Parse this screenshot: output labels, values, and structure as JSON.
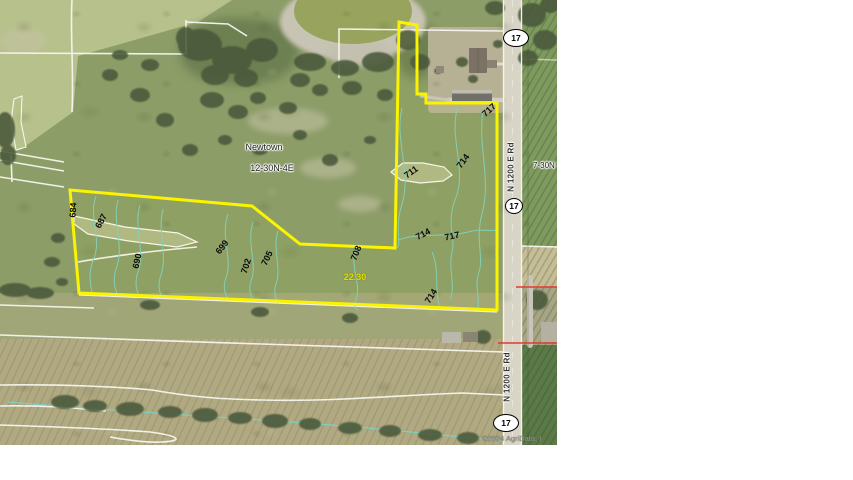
{
  "map": {
    "place_label": "Newtown",
    "section_label": "12-30N-4E",
    "adjacent_section_label": "7-30N",
    "acreage_label": "22.30",
    "road_name": "N 1200 E Rd",
    "highway_number": "17",
    "watermark": "©2024 AgriData, I",
    "contour_labels": [
      "684",
      "687",
      "690",
      "699",
      "702",
      "705",
      "708",
      "711",
      "714",
      "717",
      "714",
      "717",
      "714"
    ],
    "colors": {
      "parcel_boundary": "#fbf400",
      "contour_line": "#7ed1c0",
      "acreage_text": "#e0e000",
      "boundary_red": "#e23b2e",
      "road_surface": "#d8d4c6"
    }
  }
}
